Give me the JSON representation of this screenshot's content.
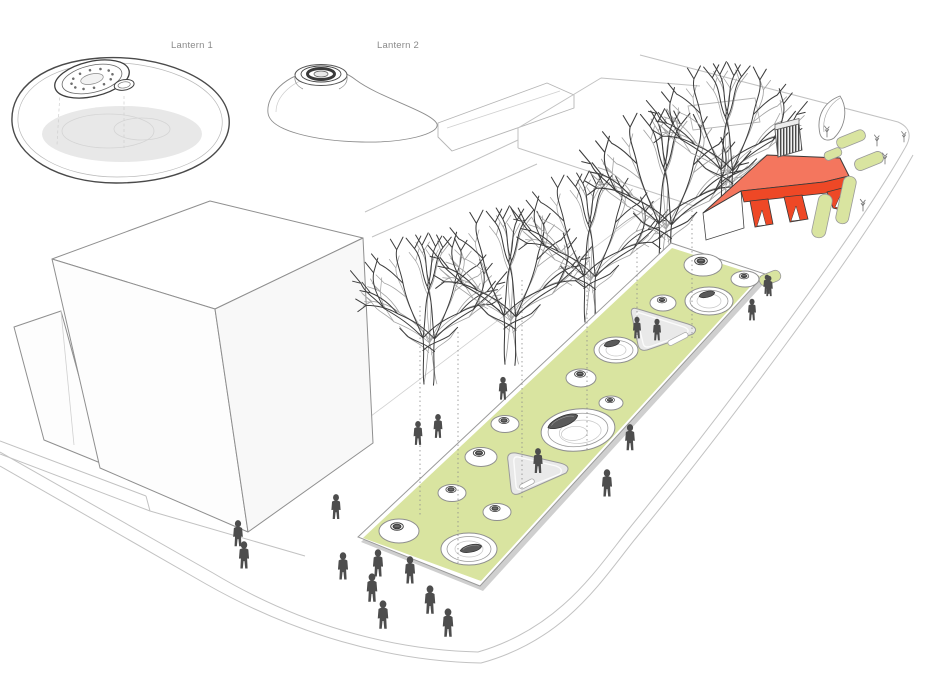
{
  "labels": {
    "lantern1": "Lantern 1",
    "lantern2": "Lantern 2"
  },
  "palette": {
    "plaza_green": "#d9e4a0",
    "building_red_roof": "#f4765e",
    "building_red_accent": "#ee4826",
    "figure_gray": "#4d4d4d",
    "sketch_line": "#c2c2c2",
    "ink": "#3a3a3a",
    "label_gray": "#8a8a8a",
    "sunken_court_gray": "#e9e9e9"
  },
  "scene": {
    "lantern_prototypes": [
      "Lantern 1",
      "Lantern 2"
    ],
    "plaza_lantern_dome_count": 14,
    "pedestrian_count": 21,
    "street_tree_count": 5,
    "planter_count": 6,
    "sunken_court_count": 2
  }
}
